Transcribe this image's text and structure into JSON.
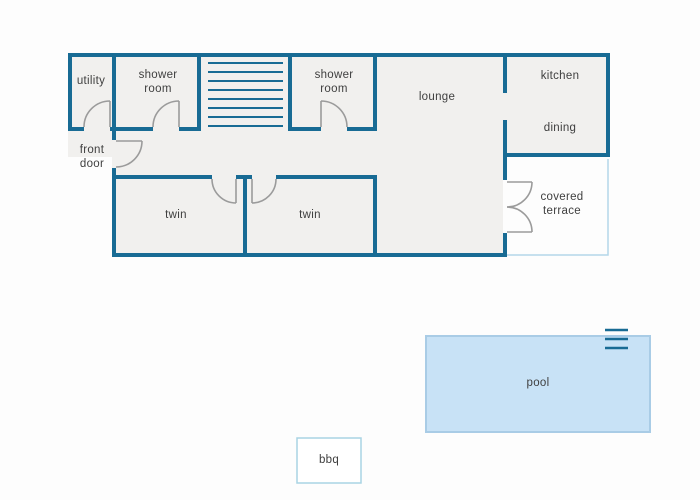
{
  "title": "house floor plan with pool",
  "colors": {
    "wall": "#186b94",
    "room_fill": "#f1f0ee",
    "background": "#fdfdfd",
    "door": "#9b9b9b",
    "pool_fill": "#c8e2f6",
    "pool_border": "#a9cce6",
    "terrace_border": "#b3d7ea",
    "bbq_border": "#a9d4e4",
    "bbq_fill": "#ffffff",
    "label_text": "#3f3f3f"
  },
  "labels": {
    "utility": "utility",
    "shower_room": "shower room",
    "lounge": "lounge",
    "kitchen": "kitchen",
    "dining": "dining",
    "front_door": "front door",
    "twin": "twin",
    "covered_terrace": "covered terrace",
    "pool": "pool",
    "bbq": "bbq"
  }
}
